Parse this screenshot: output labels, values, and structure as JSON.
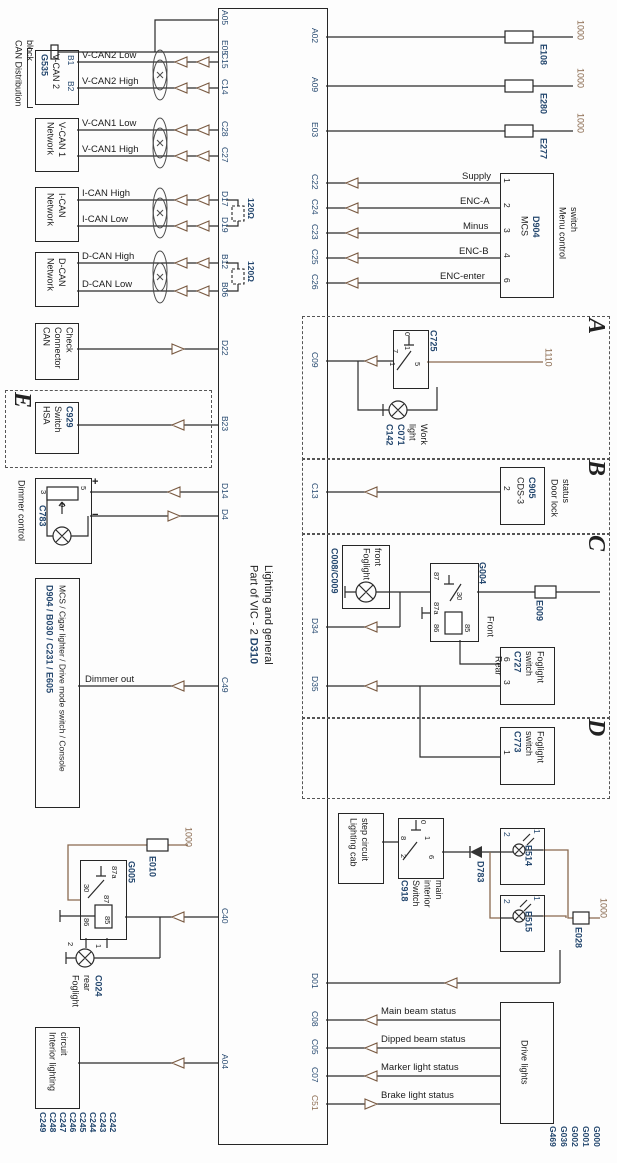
{
  "title": {
    "part": "Part of VIC - 2",
    "code": "D310",
    "subtitle": "Lighting and general"
  },
  "colors": {
    "navy": "#24476e",
    "brown": "#8a6a4f",
    "line": "#2b2b2b"
  },
  "ecu": {
    "left_pins": [
      "A05",
      "E05",
      "C15",
      "C14",
      "C28",
      "C27",
      "D17",
      "D19",
      "B12",
      "B06",
      "D22",
      "B23",
      "D14",
      "D4",
      "C49",
      "C40",
      "A04"
    ],
    "right_pins": [
      "A02",
      "A09",
      "E03",
      "C22",
      "C24",
      "C23",
      "C25",
      "C26",
      "C09",
      "C13",
      "D34",
      "D35",
      "D01",
      "C08",
      "C05",
      "C07",
      "C51"
    ]
  },
  "can": {
    "group_label": {
      "l1": "CAN Distribution",
      "l2": "block"
    },
    "dist_block": {
      "id": "G535",
      "name": "V-CAN 2",
      "pins": [
        "B1",
        "B2"
      ]
    },
    "networks": [
      {
        "name": "V-CAN 1",
        "type": "Network"
      },
      {
        "name": "I-CAN",
        "type": "Network"
      },
      {
        "name": "D-CAN",
        "type": "Network"
      }
    ],
    "wire_labels": [
      "V-CAN2 Low",
      "V-CAN2 High",
      "V-CAN1 Low",
      "V-CAN1 High",
      "I-CAN High",
      "I-CAN Low",
      "D-CAN High",
      "D-CAN Low"
    ],
    "resistor": "120Ω",
    "connector_check": {
      "l1": "CAN",
      "l2": "Connector",
      "l3": "Check"
    }
  },
  "hsa": {
    "section": "E",
    "l1": "HSA",
    "l2": "Switch",
    "id": "C929"
  },
  "dimmer": {
    "label": "Dimmer control",
    "id": "C783",
    "pins": [
      "3",
      "5",
      "9"
    ],
    "plus": "+",
    "minus": "−",
    "out_label": "Dimmer out"
  },
  "console_box": {
    "ids": "D904 / B030 / C231 / E605",
    "names": "MCS / Cigar lighter / Drive mode switch / Console"
  },
  "fuses_top": [
    {
      "id": "E108",
      "wire": "1000"
    },
    {
      "id": "E280",
      "wire": "1000"
    },
    {
      "id": "E277",
      "wire": "1000"
    }
  ],
  "menu_switch": {
    "name": "MCS",
    "id": "D904",
    "pins": [
      "1",
      "2",
      "3",
      "4",
      "6"
    ],
    "signals": [
      "Supply",
      "ENC-A",
      "Minus",
      "ENC-B",
      "ENC-enter"
    ],
    "caption_l1": "Menu control",
    "caption_l2": "switch"
  },
  "sections": {
    "a": "A",
    "b": "B",
    "c": "C",
    "d": "D"
  },
  "work_light": {
    "switch_id": "C725",
    "switch_pins": [
      "0",
      "1",
      "7",
      "1",
      "5"
    ],
    "wire": "1110",
    "name_l1": "Work",
    "name_l2": "light",
    "ids": [
      "C071",
      "C142"
    ]
  },
  "door_lock": {
    "box_l1": "CDS-3",
    "box_id": "C905",
    "box_pin": "2",
    "caption_l1": "Door lock",
    "caption_l2": "status"
  },
  "foglight": {
    "front_lamp": {
      "ids": "C008/C009",
      "l1": "Foglight",
      "l2": "front"
    },
    "relay": {
      "id": "G004",
      "pins": [
        "87",
        "30",
        "87a",
        "86",
        "85"
      ]
    },
    "fuse": "E009",
    "front_label": "Front",
    "rear_label": "Rear",
    "switch_c": {
      "id": "C727",
      "l1": "Foglight",
      "l2": "switch",
      "pins": [
        "6",
        "3"
      ]
    },
    "switch_d": {
      "id": "C773",
      "l1": "Foglight",
      "l2": "switch",
      "pins": [
        "1"
      ]
    }
  },
  "cab_step": {
    "box_l1": "Lighting cab",
    "box_l2": "step circuit",
    "switch": {
      "id": "C918",
      "l1": "Switch",
      "l2": "interior",
      "l3": "main",
      "pins": [
        "0",
        "1",
        "8",
        "2",
        "6"
      ]
    },
    "diode": "D783",
    "lamps": [
      {
        "id": "E514",
        "pins": [
          "2",
          "1"
        ]
      },
      {
        "id": "E515",
        "pins": [
          "2",
          "1"
        ]
      }
    ],
    "fuse": {
      "id": "E028",
      "wire": "1000"
    }
  },
  "rear_foglight": {
    "fuse": {
      "id": "E010",
      "wire": "1000"
    },
    "relay": {
      "id": "G005",
      "pins": [
        "87a",
        "30",
        "87",
        "85",
        "86"
      ]
    },
    "lamp": {
      "l1": "Foglight",
      "l2": "rear",
      "id": "C024",
      "pins": [
        "1",
        "2"
      ]
    }
  },
  "interior": {
    "l1": "Interior lighting",
    "l2": "circuit",
    "connectors": [
      "C242",
      "C243",
      "C244",
      "C245",
      "C246",
      "C247",
      "C248",
      "C249"
    ]
  },
  "drive_lights": {
    "label": "Drive lights",
    "signals": [
      "Main beam status",
      "Dipped beam status",
      "Marker light status",
      "Brake light status"
    ],
    "grounds": [
      "G000",
      "G001",
      "G002",
      "G036",
      "G469"
    ]
  }
}
